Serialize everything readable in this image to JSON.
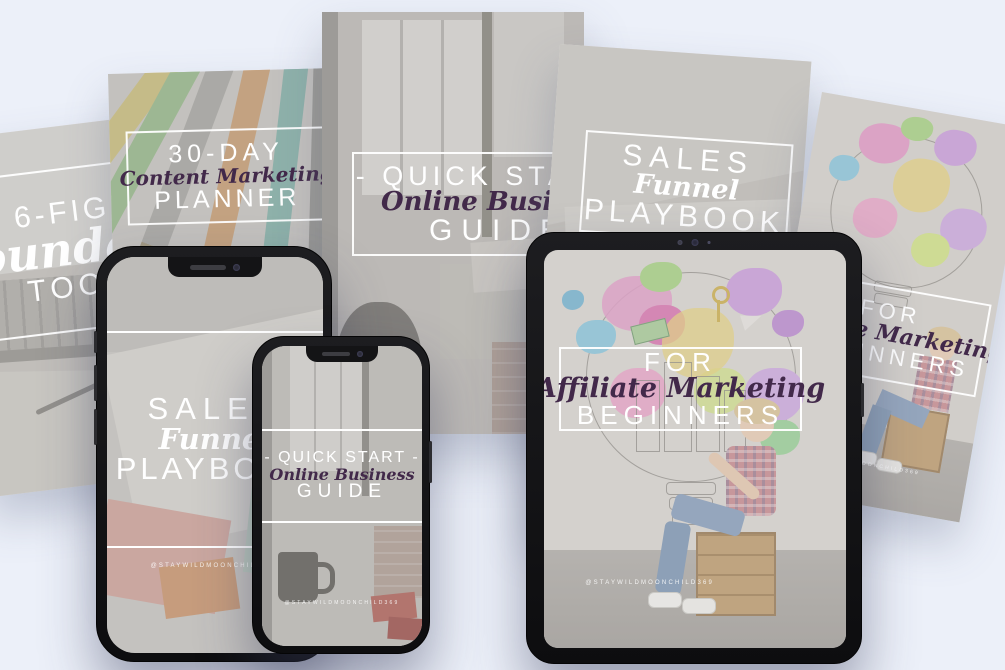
{
  "background_color": "#ecf0f9",
  "accent_colors": {
    "script_purple": "#42294a",
    "title_white": "#ffffff",
    "device_frame": "#151517",
    "paint_pink": "#e291c5",
    "paint_purple": "#c795dd",
    "paint_green": "#9ed078",
    "paint_yellow": "#e8d06e",
    "paint_teal": "#7fc3dd"
  },
  "brand": {
    "handle": "@STAYWILDMOONCHILD369"
  },
  "covers": {
    "toolkit": {
      "top": "6-FIGURE",
      "script": "Foundations",
      "bottom": "TOOLKIT"
    },
    "planner": {
      "top": "30-DAY",
      "script": "Content Marketing",
      "bottom": "PLANNER",
      "photo_word": "MARKETING PLAN"
    },
    "guide": {
      "top": "- QUICK START -",
      "script": "Online Business",
      "bottom": "GUIDE"
    },
    "playbook": {
      "top": "SALES",
      "script": "Funnel",
      "bottom": "PLAYBOOK"
    },
    "beginners": {
      "top": "FOR",
      "script": "Affiliate Marketing",
      "bottom": "BEGINNERS"
    }
  }
}
